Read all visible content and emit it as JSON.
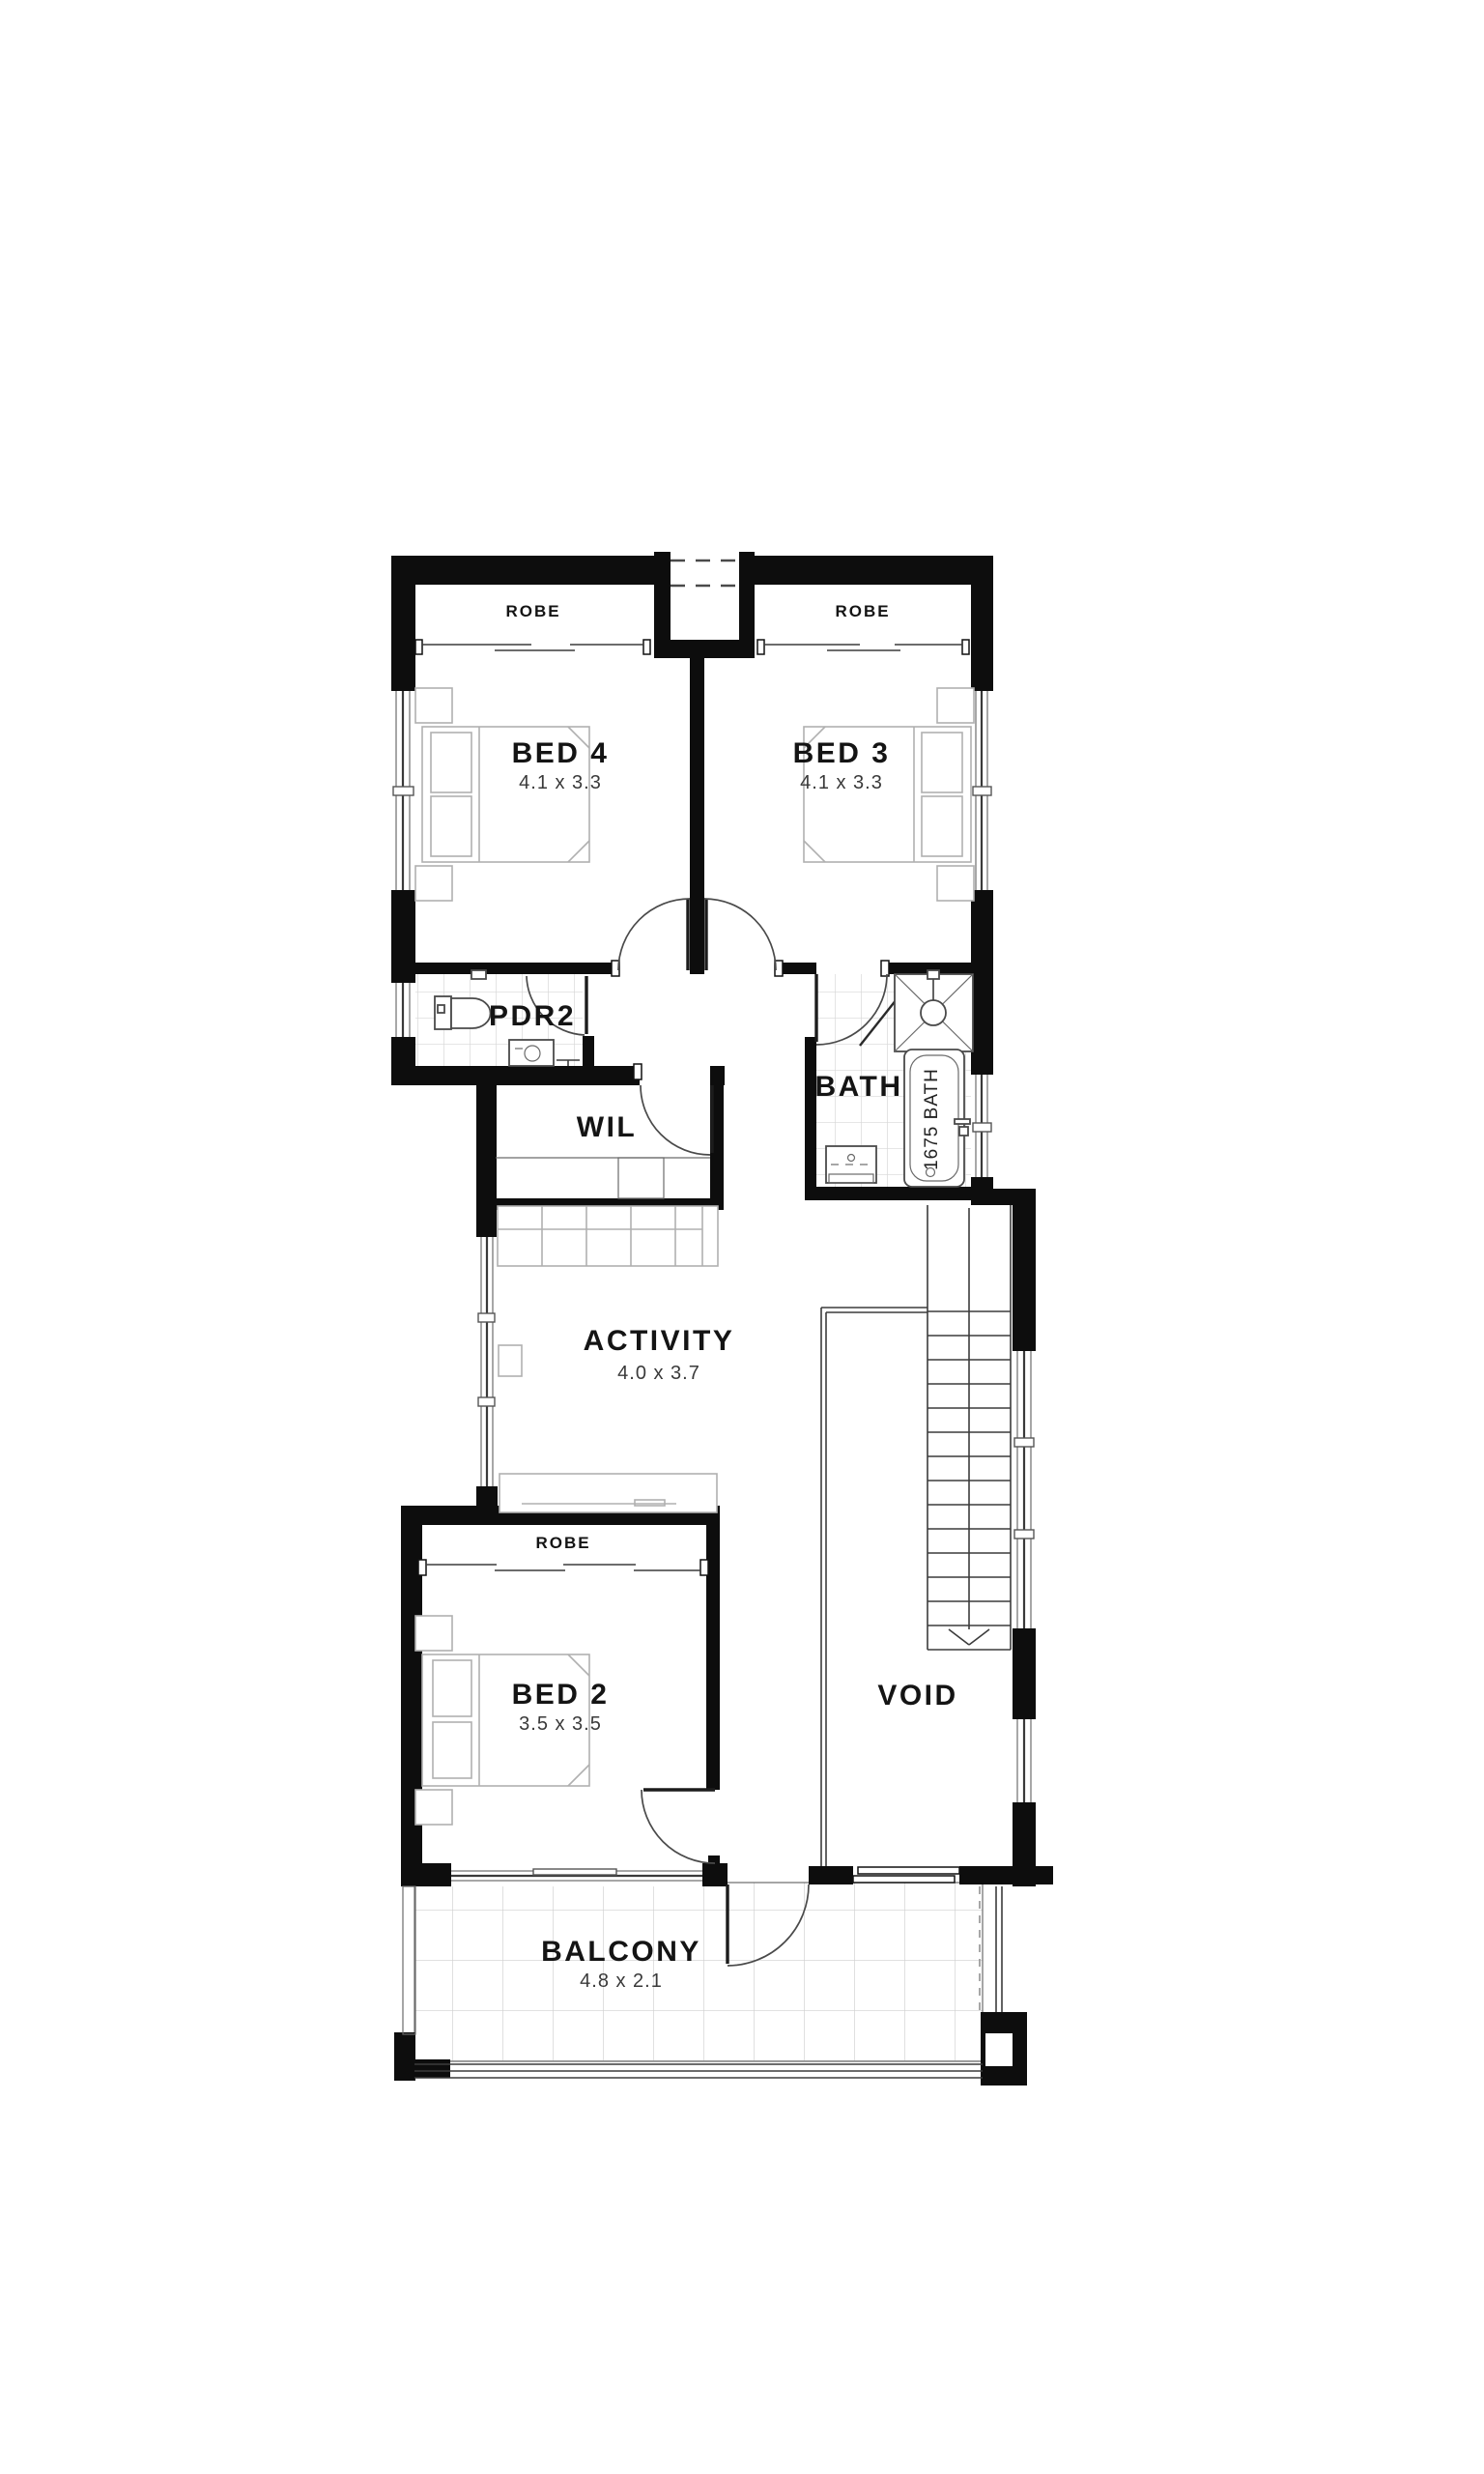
{
  "rooms": {
    "bed4": {
      "name": "BED 4",
      "dims": "4.1 x 3.3"
    },
    "bed3": {
      "name": "BED 3",
      "dims": "4.1 x 3.3"
    },
    "bed2": {
      "name": "BED 2",
      "dims": "3.5 x 3.5"
    },
    "activity": {
      "name": "ACTIVITY",
      "dims": "4.0 x 3.7"
    },
    "balcony": {
      "name": "BALCONY",
      "dims": "4.8 x 2.1"
    },
    "bath": {
      "name": "BATH"
    },
    "pdr2": {
      "name": "PDR2"
    },
    "wil": {
      "name": "WIL"
    },
    "void": {
      "name": "VOID"
    }
  },
  "labels": {
    "robe_bed4": "ROBE",
    "robe_bed3": "ROBE",
    "robe_bed2": "ROBE",
    "tub": "1675 BATH"
  },
  "colors": {
    "wall": "#0d0d0d",
    "line": "#3c3c3c",
    "furniture": "#b0b0b0",
    "tile": "#d6d6d6",
    "text": "#141414",
    "background": "#ffffff"
  }
}
